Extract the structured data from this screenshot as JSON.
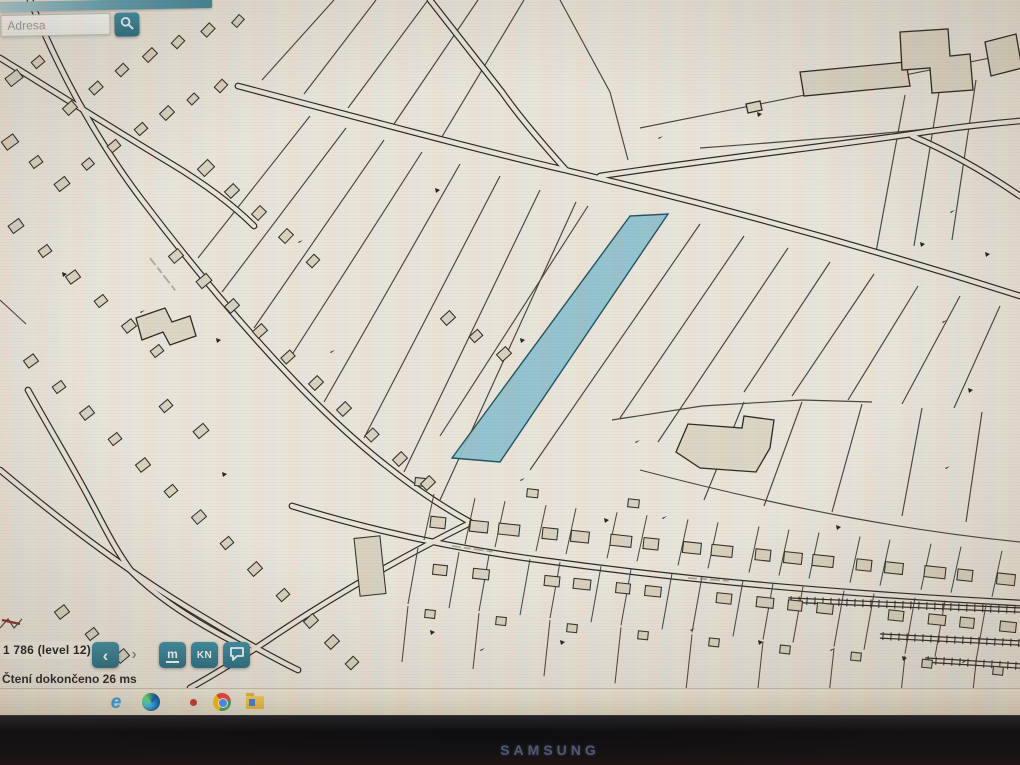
{
  "window": {
    "brand": "SAMSUNG"
  },
  "app": {
    "accent_color": "#2e7b8e",
    "search": {
      "placeholder": "Adresa",
      "icon": "magnifier"
    },
    "statusbar": {
      "scale_label": "1 786 (level 12)",
      "dropdown_glyph": "▾",
      "back_glyph": "‹",
      "forward_glyph": "›",
      "measure_label": "m",
      "kn_label": "KN",
      "status_message": "Čtení dokončeno 26 ms"
    }
  },
  "taskbar": {
    "icons": [
      "internet-explorer",
      "edge",
      "notification-dot",
      "chrome",
      "file-manager"
    ]
  },
  "map": {
    "background": "#eae6da",
    "line_color": "#37332c",
    "building_fill": "#d9d3c0",
    "highlight": {
      "fill": "#8cc0ce",
      "stroke": "#1d4f5e",
      "points": "630,216 668,214 500,462 452,458"
    },
    "roads": [
      "M 238,86 C 360,118 470,148 565,170 C 700,202 860,245 1020,296",
      "M 600,176 C 720,158 830,146 912,134 C 950,128 985,124 1020,121",
      "M 912,136 C 950,152 985,172 1020,196",
      "M 430,0 L 502,92 C 520,118 548,150 566,170",
      "M 30,0 C 58,68 95,138 142,200 C 192,266 245,330 305,392 C 352,440 408,488 470,522",
      "M 292,506 C 370,530 450,548 540,560 C 700,582 850,594 1020,603",
      "M 468,524 C 400,558 330,598 268,640 C 235,662 208,678 190,688",
      "M 0,58 C 55,92 115,130 170,163 C 205,184 232,204 254,226",
      "M 28,390 C 55,438 72,466 88,496 C 102,522 114,548 132,572 C 162,602 205,628 250,650",
      "M 0,470 C 60,520 120,566 185,606 C 228,632 265,654 298,670"
    ],
    "boundaries": [
      "M 262,80 L 334,0",
      "M 304,94 L 376,0",
      "M 348,108 L 428,0",
      "M 394,124 L 478,0",
      "M 440,140 L 524,0",
      "M 560,0 L 610,92 L 628,160",
      "M 640,128 L 1020,52",
      "M 700,148 C 810,140 910,132 1008,120",
      "M 310,116 L 198,258",
      "M 346,128 L 222,292",
      "M 384,140 L 254,328",
      "M 422,152 L 286,364",
      "M 460,164 L 324,402",
      "M 500,176 L 364,438",
      "M 540,190 L 404,472",
      "M 576,202 L 440,500",
      "M 588,206 L 440,436",
      "M 700,224 L 530,470",
      "M 744,236 L 620,418",
      "M 788,248 L 658,442",
      "M 612,420 L 702,406 L 802,400 L 872,402",
      "M 830,262 L 744,392",
      "M 874,274 L 792,396",
      "M 918,286 L 848,400",
      "M 960,296 L 902,404",
      "M 1000,306 L 954,408",
      "M 744,402 L 704,500",
      "M 802,402 L 764,506",
      "M 862,404 L 832,512",
      "M 922,408 L 902,516",
      "M 982,412 L 966,522",
      "M 640,470 C 800,512 920,532 1020,542",
      "M 905,95 L 876,252",
      "M 940,86 L 914,246",
      "M 976,80 L 952,240",
      "M 0,300 L 26,324",
      "M 0,628 l 8,-9 l 6,9 l 8,-9"
    ],
    "red_lines": [
      "M 2,620 l 18,4"
    ],
    "polygons": [
      "M 800,72 L 906,62 L 910,86 L 804,96 Z",
      "M 900,32 L 948,29 L 950,56 L 970,54 L 973,90 L 932,93 L 930,68 L 902,70 Z",
      "M 985,42 L 1016,34 L 1022,68 L 991,76 Z",
      "M 676,452 L 688,424 L 742,428 L 744,416 L 774,420 L 770,448 L 756,472 L 700,468 Z",
      "M 136,318 L 165,308 L 172,322 L 190,316 L 196,336 L 170,345 L 163,332 L 142,340 Z",
      "M 746,104 L 760,101 L 762,110 L 748,113 Z"
    ],
    "buildings": [
      [
        14,
        78,
        15,
        10,
        -38
      ],
      [
        38,
        62,
        11,
        8,
        -40
      ],
      [
        70,
        108,
        12,
        9,
        -42
      ],
      [
        96,
        88,
        12,
        8,
        -42
      ],
      [
        122,
        70,
        11,
        8,
        -44
      ],
      [
        150,
        55,
        13,
        8,
        -44
      ],
      [
        178,
        42,
        11,
        8,
        -46
      ],
      [
        208,
        30,
        12,
        8,
        -46
      ],
      [
        238,
        21,
        11,
        7,
        -48
      ],
      [
        10,
        142,
        14,
        10,
        -36
      ],
      [
        36,
        162,
        11,
        8,
        -36
      ],
      [
        62,
        184,
        13,
        9,
        -38
      ],
      [
        88,
        164,
        10,
        8,
        -40
      ],
      [
        114,
        146,
        11,
        8,
        -40
      ],
      [
        141,
        129,
        11,
        8,
        -42
      ],
      [
        167,
        113,
        12,
        9,
        -44
      ],
      [
        193,
        99,
        10,
        7,
        -44
      ],
      [
        221,
        86,
        11,
        8,
        -46
      ],
      [
        16,
        226,
        13,
        9,
        -36
      ],
      [
        45,
        251,
        11,
        8,
        -36
      ],
      [
        73,
        277,
        12,
        9,
        -36
      ],
      [
        101,
        301,
        11,
        8,
        -38
      ],
      [
        129,
        326,
        12,
        9,
        -38
      ],
      [
        157,
        351,
        11,
        8,
        -38
      ],
      [
        176,
        256,
        12,
        9,
        -40
      ],
      [
        204,
        281,
        13,
        9,
        -40
      ],
      [
        232,
        306,
        12,
        9,
        -42
      ],
      [
        260,
        331,
        12,
        9,
        -42
      ],
      [
        288,
        357,
        12,
        8,
        -42
      ],
      [
        316,
        383,
        12,
        9,
        -44
      ],
      [
        344,
        409,
        12,
        9,
        -44
      ],
      [
        372,
        435,
        11,
        9,
        -44
      ],
      [
        400,
        459,
        12,
        9,
        -44
      ],
      [
        428,
        483,
        12,
        9,
        -44
      ],
      [
        31,
        361,
        12,
        9,
        -36
      ],
      [
        59,
        387,
        11,
        8,
        -36
      ],
      [
        87,
        413,
        12,
        9,
        -38
      ],
      [
        115,
        439,
        11,
        8,
        -38
      ],
      [
        143,
        465,
        12,
        9,
        -38
      ],
      [
        171,
        491,
        11,
        8,
        -40
      ],
      [
        199,
        517,
        12,
        9,
        -40
      ],
      [
        227,
        543,
        11,
        8,
        -40
      ],
      [
        255,
        569,
        12,
        9,
        -42
      ],
      [
        283,
        595,
        11,
        8,
        -42
      ],
      [
        311,
        621,
        12,
        9,
        -42
      ],
      [
        370,
        566,
        26,
        58,
        -6
      ],
      [
        206,
        168,
        14,
        10,
        -44
      ],
      [
        232,
        191,
        12,
        9,
        -44
      ],
      [
        259,
        213,
        12,
        9,
        -46
      ],
      [
        286,
        236,
        12,
        9,
        -46
      ],
      [
        313,
        261,
        11,
        8,
        -46
      ],
      [
        166,
        406,
        11,
        8,
        -40
      ],
      [
        201,
        431,
        13,
        9,
        -40
      ],
      [
        62,
        612,
        12,
        9,
        -38
      ],
      [
        92,
        634,
        11,
        8,
        -38
      ],
      [
        122,
        656,
        12,
        9,
        -40
      ],
      [
        332,
        642,
        12,
        9,
        -44
      ],
      [
        352,
        663,
        11,
        8,
        -44
      ],
      [
        448,
        318,
        12,
        9,
        -42
      ],
      [
        476,
        336,
        11,
        8,
        -42
      ],
      [
        504,
        354,
        12,
        9,
        -42
      ]
    ],
    "markers": [
      [
        435,
        188
      ],
      [
        298,
        242
      ],
      [
        216,
        338
      ],
      [
        330,
        352
      ],
      [
        62,
        272
      ],
      [
        140,
        312
      ],
      [
        520,
        338
      ],
      [
        635,
        442
      ],
      [
        604,
        518
      ],
      [
        662,
        518
      ],
      [
        836,
        525
      ],
      [
        690,
        630
      ],
      [
        758,
        640
      ],
      [
        830,
        650
      ],
      [
        902,
        656
      ],
      [
        962,
        662
      ],
      [
        920,
        242
      ],
      [
        950,
        212
      ],
      [
        985,
        252
      ],
      [
        942,
        322
      ],
      [
        968,
        388
      ],
      [
        945,
        468
      ],
      [
        757,
        112
      ],
      [
        658,
        138
      ],
      [
        222,
        472
      ],
      [
        520,
        480
      ],
      [
        560,
        640
      ],
      [
        480,
        650
      ],
      [
        430,
        630
      ]
    ],
    "railways": [
      [
        788,
        600,
        1020,
        610
      ],
      [
        880,
        636,
        1020,
        643
      ],
      [
        925,
        660,
        1020,
        666
      ]
    ],
    "street": {
      "x0": 425,
      "count": 17,
      "step": 35,
      "base_y": 552,
      "ref_x": 500,
      "slope": 0.1
    },
    "label_squiggles": [
      [
        150,
        258,
        52
      ],
      [
        452,
        546,
        8
      ],
      [
        688,
        578,
        4
      ]
    ]
  }
}
